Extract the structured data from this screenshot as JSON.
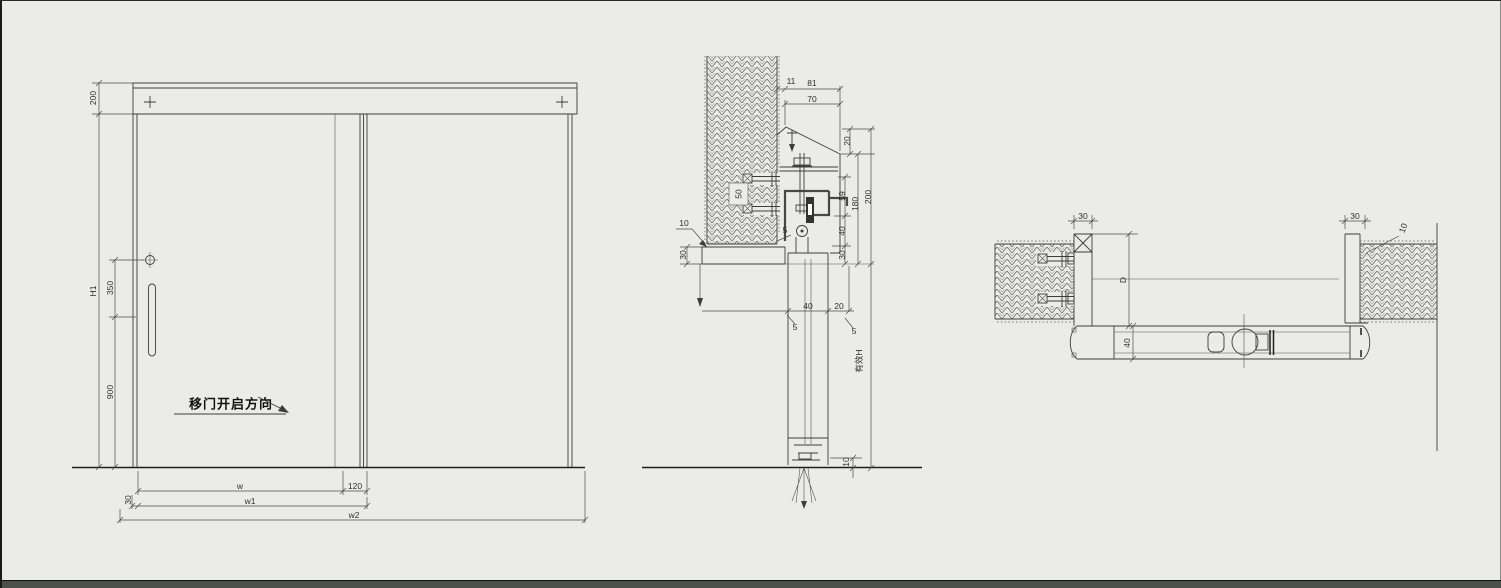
{
  "colors": {
    "background": "#ebecea",
    "line": "#3c3c3c",
    "dark_line": "#1f1f1f"
  },
  "elevation": {
    "dim_header_height": "200",
    "dim_door_height": "H1",
    "dim_handle_offset": "350",
    "dim_handle_height": "900",
    "dim_clear_width": "w",
    "dim_overlap": "120",
    "dim_edge_margin": "30",
    "dim_leaf_width": "w1",
    "dim_overall_width": "w2",
    "note_direction": "移门开启方向"
  },
  "section": {
    "dim_top_11": "11",
    "dim_top_81": "81",
    "dim_top_70": "70",
    "dim_right_20": "20",
    "dim_right_59": "59",
    "dim_right_40": "40",
    "dim_right_30": "30",
    "dim_right_180": "180",
    "dim_right_200": "200",
    "dim_effective_height": "有效H",
    "dim_floor_gap": "10",
    "dim_left_offset": "10",
    "dim_ceiling_band": "30",
    "dim_wall_anchor": "50",
    "dim_mid_40": "40",
    "dim_mid_20": "20",
    "dim_leader_5a": "5",
    "dim_leader_5b": "5",
    "dim_leader_5c": "5"
  },
  "plan": {
    "dim_left_jamb": "30",
    "dim_opening_depth": "D",
    "dim_door_thickness": "40",
    "dim_right_jamb": "30",
    "dim_wall_gap": "10"
  }
}
